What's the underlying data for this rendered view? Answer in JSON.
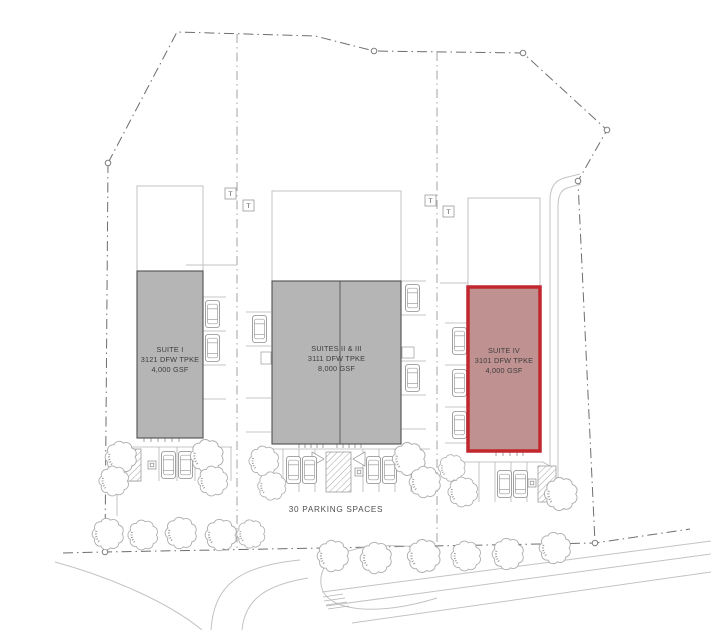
{
  "site_plan": {
    "buildings": [
      {
        "name": "SUITE I",
        "address": "3121 DFW TPKE",
        "area": "4,000 GSF",
        "highlighted": false
      },
      {
        "name": "SUITES II & III",
        "address": "3111 DFW TPKE",
        "area": "8,000 GSF",
        "highlighted": false
      },
      {
        "name": "SUITE IV",
        "address": "3101 DFW TPKE",
        "area": "4,000 GSF",
        "highlighted": true
      }
    ],
    "labels": {
      "parking": "30 PARKING SPACES",
      "transformer": "T"
    },
    "colors": {
      "building_fill": "#b5b5b5",
      "building_border": "#4f4f4f",
      "highlight_fill": "#c09191",
      "highlight_border": "#c1272d",
      "boundary_line": "#6e6e6e",
      "site_line": "#c3c3c3",
      "label_text": "#3d3d3d"
    },
    "icons": {
      "tree": "deciduous-tree-plan",
      "car": "parked-car-top-view",
      "transformer": "boxed-T",
      "keynote": "boxed-square",
      "boundary_vertex": "survey-point-circle"
    }
  }
}
